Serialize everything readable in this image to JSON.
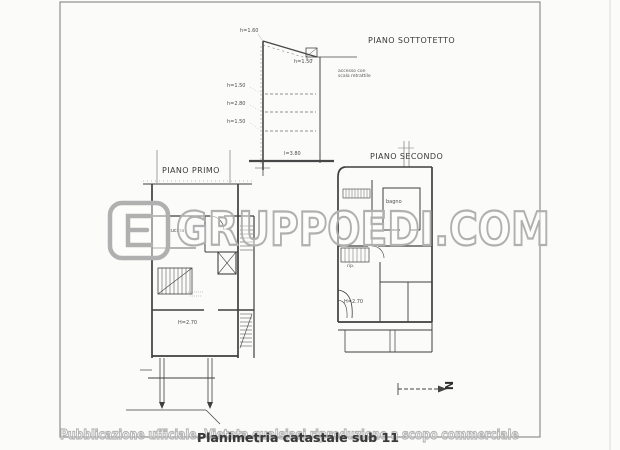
{
  "titles": {
    "sottotetto": "PIANO SOTTOTETTO",
    "primo": "PIANO PRIMO",
    "secondo": "PIANO SECONDO"
  },
  "section": {
    "top_height": "h=1.60",
    "eave_height": "h=1.50",
    "left_heights": [
      "h=1.50",
      "h=2.80",
      "h=1.50"
    ],
    "bottom_width": "l=3.80",
    "access_note_line1": "accesso con",
    "access_note_line2": "scala retrattile"
  },
  "piano_primo": {
    "room_label": "cucina",
    "height_label": "H=2.70"
  },
  "piano_secondo": {
    "bath_label": "bagno",
    "storage_label": "rip.",
    "height_label": "H=2.70"
  },
  "compass": {
    "north_label": "N"
  },
  "watermark": {
    "brand": "GRUPPOEDI.COM",
    "disclaimer": "Pubblicazione ufficiale. Vietata qualsiasi riproduzione a scopo commerciale"
  },
  "footer": {
    "caption": "Planimetria catastale sub 11"
  },
  "colors": {
    "line": "#3f3f3f",
    "watermark_stroke": "#b0b0b0",
    "caption_text": "#3a3a3a",
    "paper": "#fbfbfa"
  }
}
